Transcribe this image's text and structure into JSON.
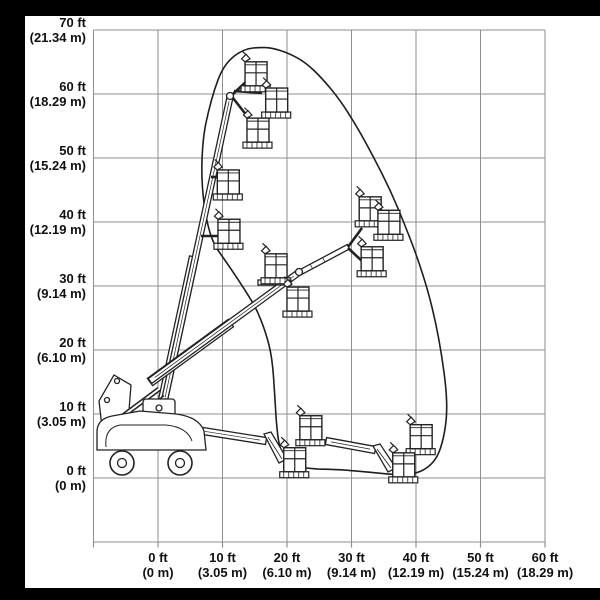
{
  "axes": {
    "y_ticks": [
      {
        "value": 70,
        "ft": "70 ft",
        "m": "(21.34 m)"
      },
      {
        "value": 60,
        "ft": "60 ft",
        "m": "(18.29 m)"
      },
      {
        "value": 50,
        "ft": "50 ft",
        "m": "(15.24 m)"
      },
      {
        "value": 40,
        "ft": "40 ft",
        "m": "(12.19 m)"
      },
      {
        "value": 30,
        "ft": "30 ft",
        "m": "(9.14 m)"
      },
      {
        "value": 20,
        "ft": "20 ft",
        "m": "(6.10 m)"
      },
      {
        "value": 10,
        "ft": "10 ft",
        "m": "(3.05 m)"
      },
      {
        "value": 0,
        "ft": "0 ft",
        "m": "(0 m)"
      }
    ],
    "x_ticks": [
      {
        "value": 0,
        "ft": "0 ft",
        "m": "(0 m)"
      },
      {
        "value": 10,
        "ft": "10 ft",
        "m": "(3.05 m)"
      },
      {
        "value": 20,
        "ft": "20 ft",
        "m": "(6.10 m)"
      },
      {
        "value": 30,
        "ft": "30 ft",
        "m": "(9.14 m)"
      },
      {
        "value": 40,
        "ft": "40 ft",
        "m": "(12.19 m)"
      },
      {
        "value": 50,
        "ft": "50 ft",
        "m": "(15.24 m)"
      },
      {
        "value": 60,
        "ft": "60 ft",
        "m": "(18.29 m)"
      }
    ]
  },
  "chart_data": {
    "type": "area",
    "title": "",
    "xlabel": "",
    "ylabel": "",
    "x_range_ft": [
      -10,
      60
    ],
    "y_range_ft": [
      -10,
      70
    ],
    "grid": true,
    "legend": "none",
    "envelope_ft": [
      [
        22.5,
        1.6
      ],
      [
        20.2,
        2.5
      ],
      [
        18.9,
        4.4
      ],
      [
        18.4,
        7.8
      ],
      [
        18.1,
        13.0
      ],
      [
        17.7,
        18.8
      ],
      [
        16.7,
        22.8
      ],
      [
        15.2,
        26.6
      ],
      [
        13.2,
        29.8
      ],
      [
        10.7,
        33.6
      ],
      [
        8.7,
        36.4
      ],
      [
        7.8,
        39.1
      ],
      [
        7.1,
        42.7
      ],
      [
        6.8,
        46.6
      ],
      [
        6.8,
        50.0
      ],
      [
        7.1,
        53.9
      ],
      [
        7.8,
        57.2
      ],
      [
        8.7,
        60.6
      ],
      [
        9.9,
        63.8
      ],
      [
        11.5,
        65.8
      ],
      [
        13.5,
        67.0
      ],
      [
        15.5,
        67.3
      ],
      [
        17.7,
        67.2
      ],
      [
        20.2,
        66.4
      ],
      [
        22.8,
        65.0
      ],
      [
        25.4,
        62.5
      ],
      [
        28.2,
        59.1
      ],
      [
        30.9,
        54.8
      ],
      [
        33.5,
        50.0
      ],
      [
        36.0,
        45.0
      ],
      [
        38.1,
        40.0
      ],
      [
        40.2,
        34.5
      ],
      [
        41.9,
        29.1
      ],
      [
        43.1,
        24.1
      ],
      [
        44.0,
        19.1
      ],
      [
        44.7,
        13.8
      ],
      [
        44.8,
        9.8
      ],
      [
        44.3,
        6.3
      ],
      [
        43.4,
        3.4
      ],
      [
        41.9,
        1.6
      ],
      [
        39.7,
        0.6
      ],
      [
        36.9,
        0.5
      ],
      [
        32.9,
        0.9
      ],
      [
        28.2,
        1.3
      ],
      [
        24.8,
        1.4
      ]
    ],
    "platform_positions_ft": [
      [
        15.2,
        63.0
      ],
      [
        18.4,
        58.9
      ],
      [
        15.5,
        54.2
      ],
      [
        10.9,
        46.1
      ],
      [
        11.0,
        38.4
      ],
      [
        18.3,
        33.0
      ],
      [
        21.7,
        27.8
      ],
      [
        32.9,
        41.9
      ],
      [
        35.8,
        39.8
      ],
      [
        33.2,
        34.1
      ],
      [
        23.7,
        7.7
      ],
      [
        21.2,
        2.7
      ],
      [
        40.8,
        6.3
      ],
      [
        38.1,
        1.9
      ]
    ]
  },
  "colors": {
    "background": "#ffffff",
    "frame_bar": "#000000",
    "grid_line": "#8f8f8f",
    "drawing_line": "#1e1e1e",
    "text": "#111111"
  }
}
